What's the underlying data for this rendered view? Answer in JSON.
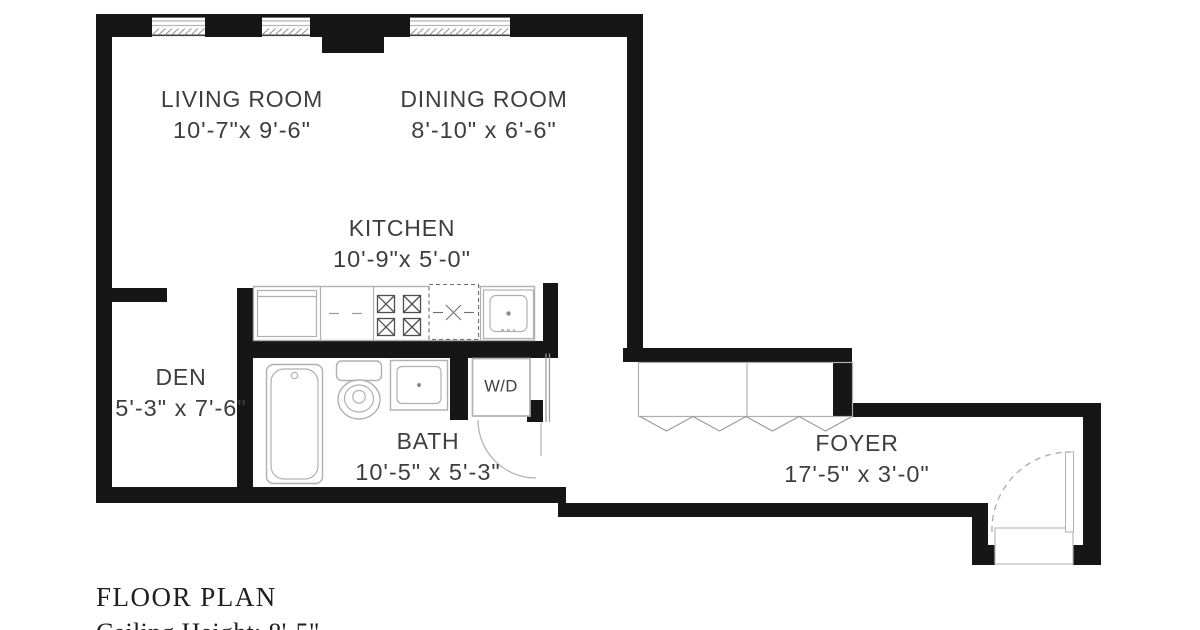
{
  "rooms": {
    "living": {
      "name": "LIVING ROOM",
      "dims": "10'-7\"x 9'-6\""
    },
    "dining": {
      "name": "DINING ROOM",
      "dims": "8'-10\" x 6'-6\""
    },
    "kitchen": {
      "name": "KITCHEN",
      "dims": "10'-9\"x 5'-0\""
    },
    "den": {
      "name": "DEN",
      "dims": "5'-3\" x 7'-6\""
    },
    "bath": {
      "name": "BATH",
      "dims": "10'-5\" x 5'-3\""
    },
    "foyer": {
      "name": "FOYER",
      "dims": "17'-5\" x 3'-0\""
    }
  },
  "appliances": {
    "washer_dryer": "W/D"
  },
  "footer": {
    "title": "FLOOR PLAN",
    "ceiling": "Ceiling Height: 8'-5\""
  },
  "colors": {
    "wall": "#161616",
    "fixture": "#b0b0b0",
    "accent_text": "#3e3e3e",
    "footer_text": "#1f1f1f"
  }
}
